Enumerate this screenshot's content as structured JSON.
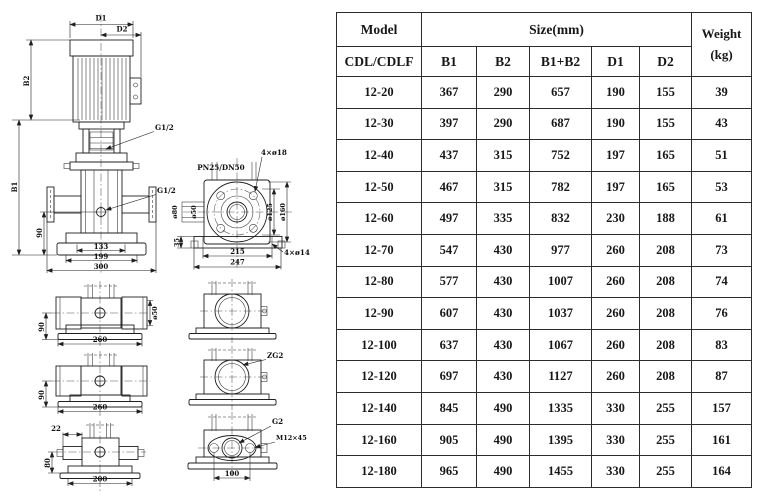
{
  "drawing": {
    "main_view": {
      "d1": "D1",
      "d2": "D2",
      "b2": "B2",
      "b1": "B1",
      "g12_top": "G1/2",
      "g12_mid": "G1/2",
      "h90": "90",
      "w133": "133",
      "w199": "199",
      "w300": "300"
    },
    "flange_view": {
      "title": "PN25/DN50",
      "bolts_top": "4×ø18",
      "d80": "ø80",
      "d50": "ø50",
      "d125": "ø125",
      "d160": "ø160",
      "h35": "35",
      "w215": "215",
      "w247": "247",
      "bolts_bottom": "4×ø14"
    },
    "side_view_1": {
      "h90": "90",
      "d50": "ø50",
      "w260": "260"
    },
    "side_view_2": {
      "h90": "90",
      "w260": "260"
    },
    "side_view_3": {
      "t22": "22",
      "h80": "80",
      "w200": "200"
    },
    "port_view_2": {
      "zg2": "ZG2"
    },
    "port_view_3": {
      "g2": "G2",
      "m12": "M12×45",
      "w100": "100"
    }
  },
  "table": {
    "header": {
      "model": "Model",
      "size": "Size(mm)",
      "weight_line1": "Weight",
      "weight_line2": "(kg)",
      "series": "CDL/CDLF",
      "cols": [
        "B1",
        "B2",
        "B1+B2",
        "D1",
        "D2"
      ]
    },
    "rows": [
      [
        "12-20",
        "367",
        "290",
        "657",
        "190",
        "155",
        "39"
      ],
      [
        "12-30",
        "397",
        "290",
        "687",
        "190",
        "155",
        "43"
      ],
      [
        "12-40",
        "437",
        "315",
        "752",
        "197",
        "165",
        "51"
      ],
      [
        "12-50",
        "467",
        "315",
        "782",
        "197",
        "165",
        "53"
      ],
      [
        "12-60",
        "497",
        "335",
        "832",
        "230",
        "188",
        "61"
      ],
      [
        "12-70",
        "547",
        "430",
        "977",
        "260",
        "208",
        "73"
      ],
      [
        "12-80",
        "577",
        "430",
        "1007",
        "260",
        "208",
        "74"
      ],
      [
        "12-90",
        "607",
        "430",
        "1037",
        "260",
        "208",
        "76"
      ],
      [
        "12-100",
        "637",
        "430",
        "1067",
        "260",
        "208",
        "83"
      ],
      [
        "12-120",
        "697",
        "430",
        "1127",
        "260",
        "208",
        "87"
      ],
      [
        "12-140",
        "845",
        "490",
        "1335",
        "330",
        "255",
        "157"
      ],
      [
        "12-160",
        "905",
        "490",
        "1395",
        "330",
        "255",
        "161"
      ],
      [
        "12-180",
        "965",
        "490",
        "1455",
        "330",
        "255",
        "164"
      ]
    ]
  }
}
